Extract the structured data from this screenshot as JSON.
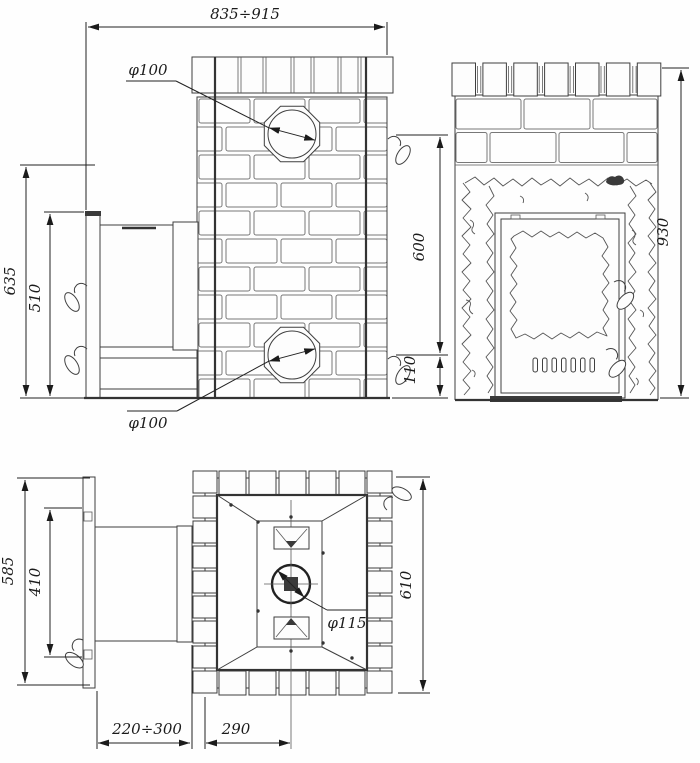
{
  "drawing": {
    "type": "technical drawing — brick-clad sauna stove, three orthographic views",
    "background": "#ffffff",
    "line_color": "#3f3f3f",
    "dim_color": "#222222"
  },
  "dimensions": {
    "side_view": {
      "total_width": "835÷915",
      "front_height": "635",
      "door_unit_height": "510",
      "flue_spacing": "600",
      "flue_bottom_offset": "110",
      "top_flue_diameter": "φ100",
      "rear_flue_diameter": "φ100"
    },
    "front_view": {
      "total_height": "930"
    },
    "plan_view": {
      "front_depth": "585",
      "door_unit_depth": "410",
      "body_depth": "610",
      "chimney_diameter": "φ115",
      "tunnel_length": "220÷300",
      "chimney_offset": "290"
    }
  }
}
